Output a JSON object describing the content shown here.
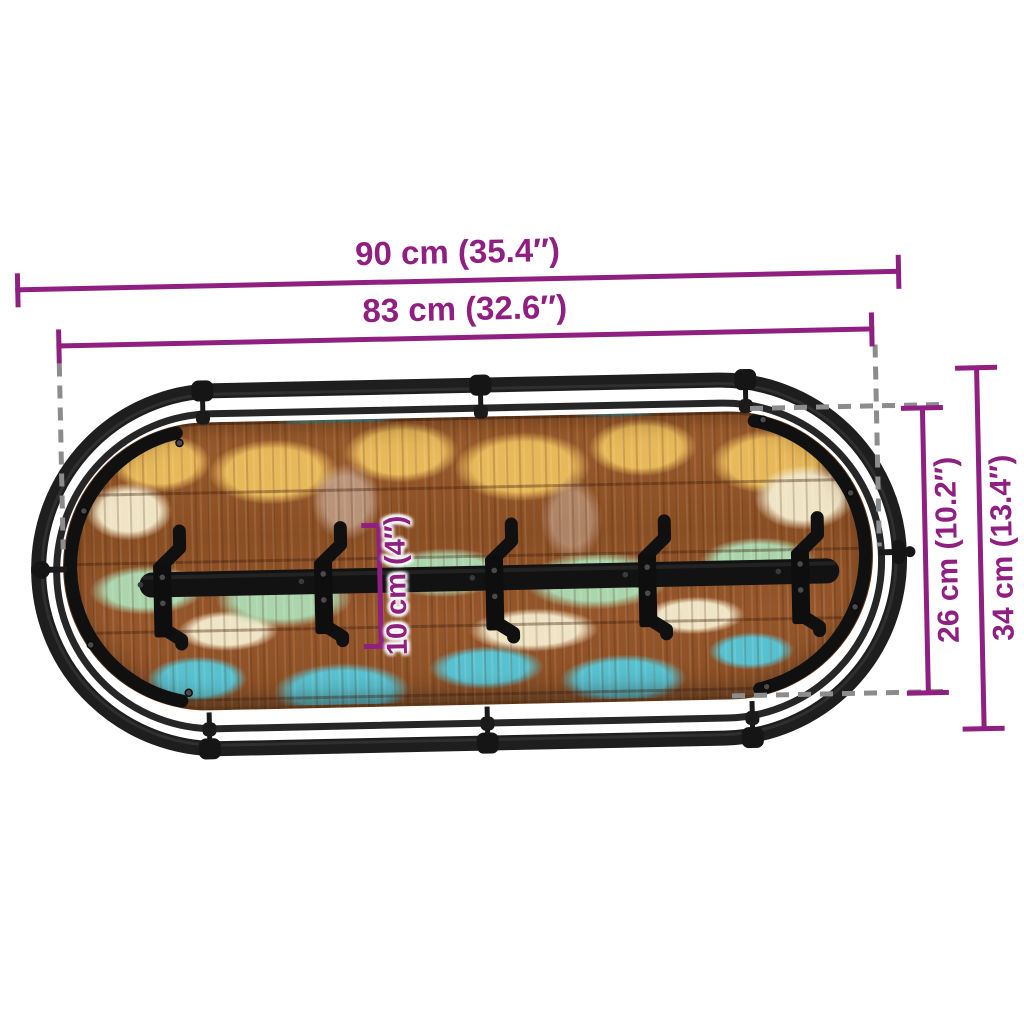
{
  "scene": {
    "background": "#ffffff",
    "description": "Dimension diagram of a wall-mounted coat rack: an oval black metal tube frame enclosing an oval reclaimed-wood panel with multicoloured distressed paint and a horizontal black bar carrying five double coat hooks"
  },
  "colors": {
    "scene_background": "#ffffff",
    "dimension_accent": "#8f1f80",
    "extension_dash": "#8c8c8c",
    "metal_frame": "#1e1e1e",
    "metal_dark": "#101010",
    "paint_yellow": "#e8b959",
    "paint_cream": "#efe4c4",
    "paint_mint": "#abd6ad",
    "paint_teal": "#58c1cf"
  },
  "product": {
    "hook_count": 5
  },
  "dimensions": {
    "overall_width": {
      "label": "90 cm (35.4″)",
      "cm": 90,
      "inches": 35.4
    },
    "panel_width": {
      "label": "83 cm (32.6″)",
      "cm": 83,
      "inches": 32.6
    },
    "overall_height": {
      "label": "34 cm (13.4″)",
      "cm": 34,
      "inches": 13.4
    },
    "panel_height": {
      "label": "26 cm (10.2″)",
      "cm": 26,
      "inches": 10.2
    },
    "hook_height": {
      "label": "10 cm (4″)",
      "cm": 10,
      "inches": 4
    }
  }
}
